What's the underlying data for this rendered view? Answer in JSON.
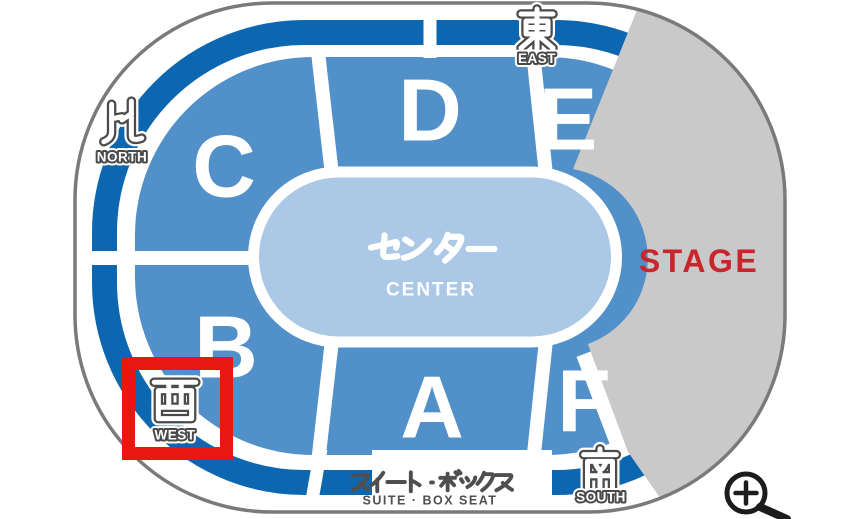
{
  "page": {
    "type": "arena-seating-map"
  },
  "colors": {
    "outline_gray": "#7a7a7a",
    "ring_blue": "#0c67b0",
    "section_blue": "#5190c8",
    "center_blue": "#abc8e6",
    "stage_gray": "#c9c9ca",
    "stage_red": "#c9252d",
    "highlight_red": "#e8170f",
    "label_gray": "#4f4f4f",
    "marker_outline": "#4a4a4a",
    "icon_black": "#1c1c1c"
  },
  "sections": [
    {
      "label": "C"
    },
    {
      "label": "D"
    },
    {
      "label": "E"
    },
    {
      "label": "B"
    },
    {
      "label": "A"
    },
    {
      "label": "F"
    }
  ],
  "center_zone": {
    "label_jp": "センター",
    "label_en": "CENTER"
  },
  "stage": {
    "label": "STAGE"
  },
  "markers": {
    "north": {
      "label_jp": "北",
      "label_en": "NORTH"
    },
    "east": {
      "label_jp": "東",
      "label_en": "EAST"
    },
    "west": {
      "label_jp": "西",
      "label_en": "WEST",
      "highlighted": true
    },
    "south": {
      "label_jp": "南",
      "label_en": "SOUTH"
    }
  },
  "suite_box": {
    "label_jp": "スイート・ボックス",
    "label_en": "SUITE · BOX SEAT"
  },
  "controls": {
    "zoom_in": {
      "icon": "magnifier-plus-icon"
    }
  }
}
